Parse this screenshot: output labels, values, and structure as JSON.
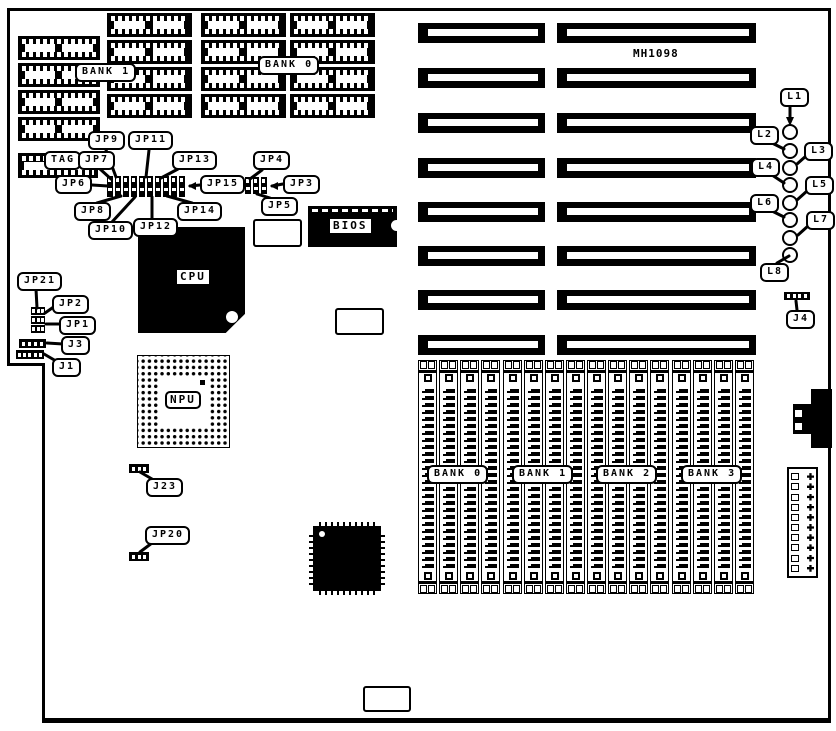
{
  "board": {
    "model": "MH1098",
    "dip_bank_labels": {
      "bank1": "BANK 1",
      "bank0": "BANK 0"
    },
    "cache_tag_label": "TAG",
    "chip_labels": {
      "cpu": "CPU",
      "npu": "NPU",
      "bios": "BIOS"
    },
    "jumper_labels": {
      "jp1": "JP1",
      "jp2": "JP2",
      "jp3": "JP3",
      "jp4": "JP4",
      "jp5": "JP5",
      "jp6": "JP6",
      "jp7": "JP7",
      "jp8": "JP8",
      "jp9": "JP9",
      "jp10": "JP10",
      "jp11": "JP11",
      "jp12": "JP12",
      "jp13": "JP13",
      "jp14": "JP14",
      "jp15": "JP15",
      "jp20": "JP20",
      "jp21": "JP21"
    },
    "connector_labels": {
      "j1": "J1",
      "j3": "J3",
      "j4": "J4",
      "j23": "J23"
    },
    "led_labels": {
      "l1": "L1",
      "l2": "L2",
      "l3": "L3",
      "l4": "L4",
      "l5": "L5",
      "l6": "L6",
      "l7": "L7",
      "l8": "L8"
    },
    "simm_bank_labels": [
      "BANK 0",
      "BANK 1",
      "BANK 2",
      "BANK 3"
    ]
  }
}
